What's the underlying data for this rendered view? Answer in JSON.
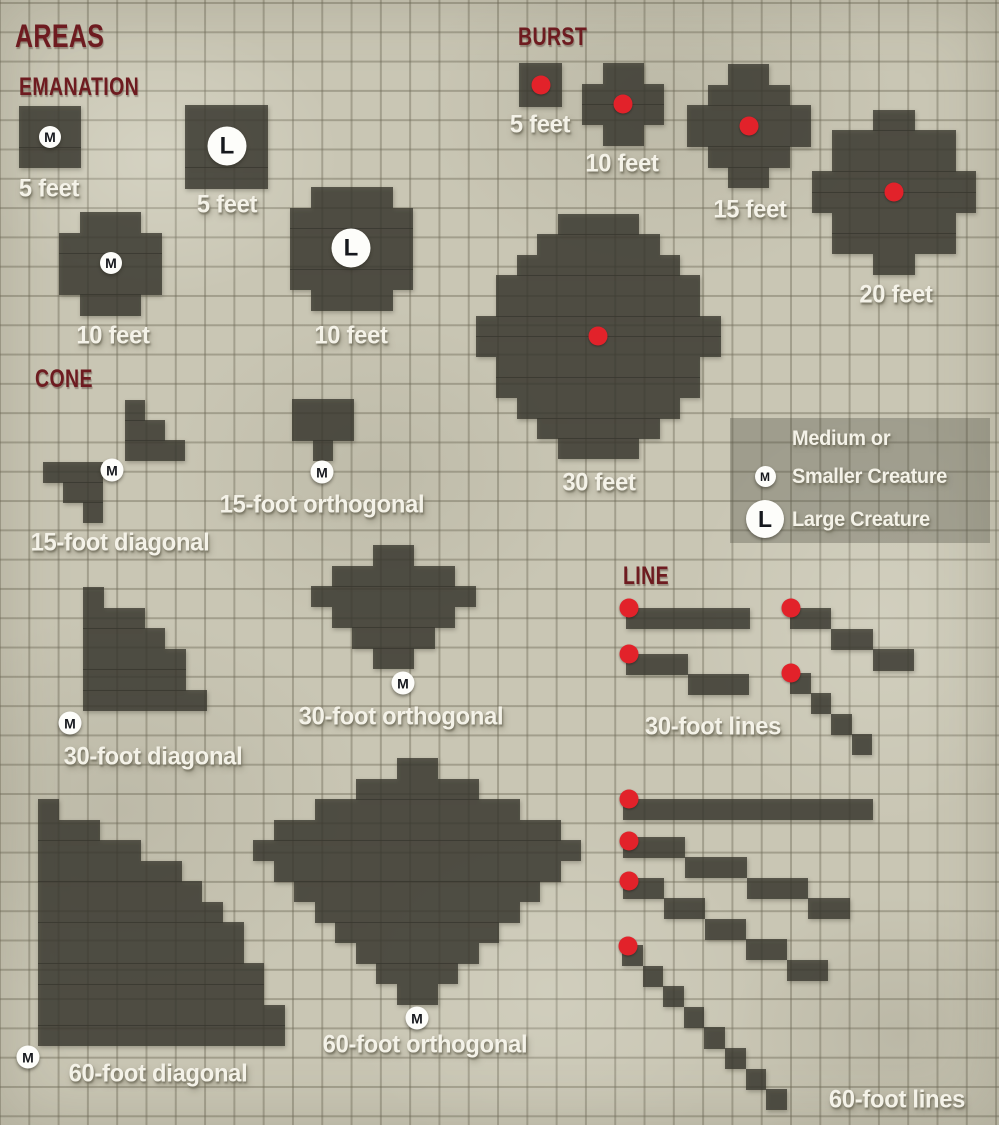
{
  "title": "AREAS",
  "colors": {
    "background": "#c9c6b4",
    "grid_line": "rgba(108,104,86,0.42)",
    "shape_fill": "rgba(56,55,46,0.78)",
    "burst_dot": "#e2222a",
    "header_text": "#6e1b20",
    "label_text": "#f4f2e8",
    "label_shadow": "rgba(118,115,97,0.95)",
    "token_bg": "#fdfdfa",
    "token_text": "#16181d",
    "legend_bg": "rgba(70,70,58,0.32)"
  },
  "grid": {
    "background_cell_px": 29.3,
    "shape_cell_px": 20.5
  },
  "headers": [
    {
      "id": "areas",
      "text": "AREAS",
      "x": 15,
      "y": 20,
      "size": 32
    },
    {
      "id": "emanation",
      "text": "EMANATION",
      "x": 19,
      "y": 75,
      "size": 25
    },
    {
      "id": "burst",
      "text": "BURST",
      "x": 518,
      "y": 25,
      "size": 25
    },
    {
      "id": "cone",
      "text": "CONE",
      "x": 35,
      "y": 367,
      "size": 25
    },
    {
      "id": "line",
      "text": "LINE",
      "x": 623,
      "y": 564,
      "size": 25
    }
  ],
  "labels": [
    {
      "id": "emanation-5ft-medium",
      "text": "5 feet",
      "x": 49,
      "y": 189
    },
    {
      "id": "emanation-5ft-large",
      "text": "5 feet",
      "x": 227,
      "y": 205
    },
    {
      "id": "emanation-10ft-medium",
      "text": "10 feet",
      "x": 113,
      "y": 336
    },
    {
      "id": "emanation-10ft-large",
      "text": "10 feet",
      "x": 351,
      "y": 336
    },
    {
      "id": "burst-5ft",
      "text": "5 feet",
      "x": 540,
      "y": 125
    },
    {
      "id": "burst-10ft",
      "text": "10 feet",
      "x": 622,
      "y": 164
    },
    {
      "id": "burst-15ft",
      "text": "15 feet",
      "x": 750,
      "y": 210
    },
    {
      "id": "burst-20ft",
      "text": "20 feet",
      "x": 896,
      "y": 295
    },
    {
      "id": "burst-30ft",
      "text": "30 feet",
      "x": 599,
      "y": 483
    },
    {
      "id": "cone-15ft-diagonal",
      "text": "15-foot diagonal",
      "x": 120,
      "y": 543
    },
    {
      "id": "cone-15ft-orthogonal",
      "text": "15-foot orthogonal",
      "x": 322,
      "y": 505
    },
    {
      "id": "cone-30ft-diagonal",
      "text": "30-foot diagonal",
      "x": 153,
      "y": 757
    },
    {
      "id": "cone-30ft-orthogonal",
      "text": "30-foot orthogonal",
      "x": 401,
      "y": 717
    },
    {
      "id": "cone-60ft-diagonal",
      "text": "60-foot diagonal",
      "x": 158,
      "y": 1074
    },
    {
      "id": "cone-60ft-orthogonal",
      "text": "60-foot orthogonal",
      "x": 425,
      "y": 1045
    },
    {
      "id": "lines-30ft",
      "text": "30-foot lines",
      "x": 713,
      "y": 727
    },
    {
      "id": "lines-60ft",
      "text": "60-foot lines",
      "x": 897,
      "y": 1100
    }
  ],
  "tokens": [
    {
      "t": "M",
      "x": 50,
      "y": 137,
      "d": 22
    },
    {
      "t": "L",
      "x": 227,
      "y": 146,
      "d": 39
    },
    {
      "t": "M",
      "x": 111,
      "y": 263,
      "d": 22
    },
    {
      "t": "L",
      "x": 351,
      "y": 248,
      "d": 39
    },
    {
      "t": "M",
      "x": 112,
      "y": 470,
      "d": 23
    },
    {
      "t": "M",
      "x": 322,
      "y": 472,
      "d": 23
    },
    {
      "t": "M",
      "x": 70,
      "y": 723,
      "d": 23
    },
    {
      "t": "M",
      "x": 403,
      "y": 683,
      "d": 23
    },
    {
      "t": "M",
      "x": 28,
      "y": 1057,
      "d": 23
    },
    {
      "t": "M",
      "x": 417,
      "y": 1018,
      "d": 23
    }
  ],
  "shapes": [
    {
      "name": "emanation-5ft-medium",
      "x": 19,
      "y": 106,
      "cell": 20.6,
      "rows": [
        [
          0,
          3
        ],
        [
          0,
          3
        ],
        [
          0,
          3
        ]
      ]
    },
    {
      "name": "emanation-5ft-large",
      "x": 185,
      "y": 105,
      "cell": 20.75,
      "rows": [
        [
          0,
          4
        ],
        [
          0,
          4
        ],
        [
          0,
          4
        ],
        [
          0,
          4
        ]
      ]
    },
    {
      "name": "emanation-10ft-medium",
      "x": 59,
      "y": 212,
      "cell": 20.6,
      "rows": [
        [
          1,
          3
        ],
        [
          0,
          5
        ],
        [
          0,
          5
        ],
        [
          0,
          5
        ],
        [
          1,
          3
        ]
      ]
    },
    {
      "name": "emanation-10ft-large",
      "x": 290,
      "y": 187,
      "cell": 20.5,
      "rows": [
        [
          1,
          4
        ],
        [
          0,
          6
        ],
        [
          0,
          6
        ],
        [
          0,
          6
        ],
        [
          0,
          6
        ],
        [
          1,
          4
        ]
      ]
    },
    {
      "name": "burst-5ft",
      "x": 519,
      "y": 63,
      "cell": 21.5,
      "rows": [
        [
          0,
          2
        ],
        [
          0,
          2
        ]
      ],
      "dot": [
        540.5,
        84.5
      ]
    },
    {
      "name": "burst-10ft",
      "x": 582,
      "y": 63,
      "cell": 20.5,
      "rows": [
        [
          1,
          2
        ],
        [
          0,
          4
        ],
        [
          0,
          4
        ],
        [
          1,
          2
        ]
      ],
      "dot": [
        623,
        104
      ]
    },
    {
      "name": "burst-15ft",
      "x": 687,
      "y": 64,
      "cell": 20.6,
      "rows": [
        [
          2,
          2
        ],
        [
          1,
          4
        ],
        [
          0,
          6
        ],
        [
          0,
          6
        ],
        [
          1,
          4
        ],
        [
          2,
          2
        ]
      ],
      "dot": [
        748.8,
        125.8
      ]
    },
    {
      "name": "burst-20ft",
      "x": 811.6,
      "y": 109.6,
      "cell": 20.6,
      "rows": [
        [
          3,
          2
        ],
        [
          1,
          6
        ],
        [
          1,
          6
        ],
        [
          0,
          8
        ],
        [
          0,
          8
        ],
        [
          1,
          6
        ],
        [
          1,
          6
        ],
        [
          3,
          2
        ]
      ],
      "dot": [
        894,
        192
      ]
    },
    {
      "name": "burst-30ft",
      "x": 476,
      "y": 214,
      "cell": 20.4,
      "rows": [
        [
          4,
          4
        ],
        [
          3,
          6
        ],
        [
          2,
          8
        ],
        [
          1,
          10
        ],
        [
          1,
          10
        ],
        [
          0,
          12
        ],
        [
          0,
          12
        ],
        [
          1,
          10
        ],
        [
          1,
          10
        ],
        [
          2,
          8
        ],
        [
          3,
          6
        ],
        [
          4,
          4
        ]
      ],
      "dot": [
        598.4,
        336.4
      ]
    },
    {
      "name": "cone-15ft-diagonal-upper",
      "x": 125,
      "y": 400,
      "cell": 20,
      "rows": [
        [
          0,
          1
        ],
        [
          0,
          2
        ],
        [
          0,
          3
        ]
      ]
    },
    {
      "name": "cone-15ft-diagonal-lower",
      "x": 42.5,
      "y": 462,
      "cell": 20.2,
      "rows": [
        [
          0,
          3
        ],
        [
          1,
          2
        ],
        [
          2,
          1
        ]
      ]
    },
    {
      "name": "cone-15ft-orthogonal",
      "x": 292,
      "y": 399,
      "cell": 20.5,
      "rows": [
        [
          0,
          3
        ],
        [
          0,
          3
        ],
        [
          1,
          1
        ]
      ]
    },
    {
      "name": "cone-30ft-diagonal",
      "x": 83,
      "y": 587,
      "cell": 20.6,
      "rows": [
        [
          0,
          1
        ],
        [
          0,
          3
        ],
        [
          0,
          4
        ],
        [
          0,
          5
        ],
        [
          0,
          5
        ],
        [
          0,
          6
        ]
      ]
    },
    {
      "name": "cone-30ft-orthogonal",
      "x": 311,
      "y": 545,
      "cell": 20.6,
      "rows": [
        [
          3,
          2
        ],
        [
          1,
          6
        ],
        [
          0,
          8
        ],
        [
          1,
          6
        ],
        [
          2,
          4
        ],
        [
          3,
          2
        ]
      ]
    },
    {
      "name": "cone-60ft-diagonal",
      "x": 38,
      "y": 799,
      "cell": 20.55,
      "rows": [
        [
          0,
          1
        ],
        [
          0,
          3
        ],
        [
          0,
          5
        ],
        [
          0,
          7
        ],
        [
          0,
          8
        ],
        [
          0,
          9
        ],
        [
          0,
          10
        ],
        [
          0,
          10
        ],
        [
          0,
          11
        ],
        [
          0,
          11
        ],
        [
          0,
          12
        ],
        [
          0,
          12
        ]
      ]
    },
    {
      "name": "cone-60ft-orthogonal",
      "x": 253,
      "y": 758,
      "cell": 20.5,
      "rows": [
        [
          7,
          2
        ],
        [
          5,
          6
        ],
        [
          3,
          10
        ],
        [
          1,
          14
        ],
        [
          0,
          16
        ],
        [
          1,
          14
        ],
        [
          2,
          12
        ],
        [
          3,
          10
        ],
        [
          4,
          8
        ],
        [
          5,
          6
        ],
        [
          6,
          4
        ],
        [
          7,
          2
        ]
      ]
    },
    {
      "name": "line-30ft-straight",
      "x": 626,
      "y": 608,
      "cell": 20.6,
      "rows": [
        [
          0,
          6
        ]
      ],
      "dot": [
        629,
        608
      ]
    },
    {
      "name": "line-30ft-stepped",
      "x": 626,
      "y": 653.5,
      "cell": 20.5,
      "rows": [
        [
          0,
          3
        ],
        [
          3,
          3
        ]
      ],
      "dot": [
        629,
        654
      ]
    },
    {
      "name": "line-30ft-double-step",
      "x": 790,
      "y": 608,
      "cell": 20.7,
      "rows": [
        [
          0,
          2
        ],
        [
          2,
          2
        ],
        [
          4,
          2
        ]
      ],
      "dot": [
        791,
        608
      ]
    },
    {
      "name": "line-30ft-diagonal",
      "x": 790,
      "y": 672.5,
      "cell": 20.5,
      "rows": [
        [
          0,
          1
        ],
        [
          1,
          1
        ],
        [
          2,
          1
        ],
        [
          3,
          1
        ]
      ],
      "dot": [
        791,
        673
      ]
    },
    {
      "name": "line-60ft-straight",
      "x": 623,
      "y": 798.5,
      "cell": 20.85,
      "rows": [
        [
          0,
          12
        ]
      ],
      "dot": [
        629,
        799
      ]
    },
    {
      "name": "line-60ft-stepped-3",
      "x": 623,
      "y": 836.5,
      "cell": 20.6,
      "rows": [
        [
          0,
          3
        ],
        [
          3,
          3
        ],
        [
          6,
          3
        ],
        [
          9,
          2
        ]
      ],
      "dot": [
        629,
        841
      ]
    },
    {
      "name": "line-60ft-stepped-2",
      "x": 623,
      "y": 877.5,
      "cell": 20.5,
      "rows": [
        [
          0,
          2
        ],
        [
          2,
          2
        ],
        [
          4,
          2
        ],
        [
          6,
          2
        ],
        [
          8,
          2
        ]
      ],
      "dot": [
        629,
        881
      ]
    },
    {
      "name": "line-60ft-diagonal",
      "x": 622,
      "y": 945,
      "cell": 20.6,
      "rows": [
        [
          0,
          1
        ],
        [
          1,
          1
        ],
        [
          2,
          1
        ],
        [
          3,
          1
        ],
        [
          4,
          1
        ],
        [
          5,
          1
        ],
        [
          6,
          1
        ],
        [
          7,
          1
        ]
      ],
      "dot": [
        628,
        946
      ]
    }
  ],
  "legend": {
    "medium_label_line1": "Medium or",
    "medium_label_line2": "Smaller Creature",
    "large_label": "Large Creature",
    "tokens": [
      {
        "t": "M"
      },
      {
        "t": "L"
      }
    ]
  }
}
